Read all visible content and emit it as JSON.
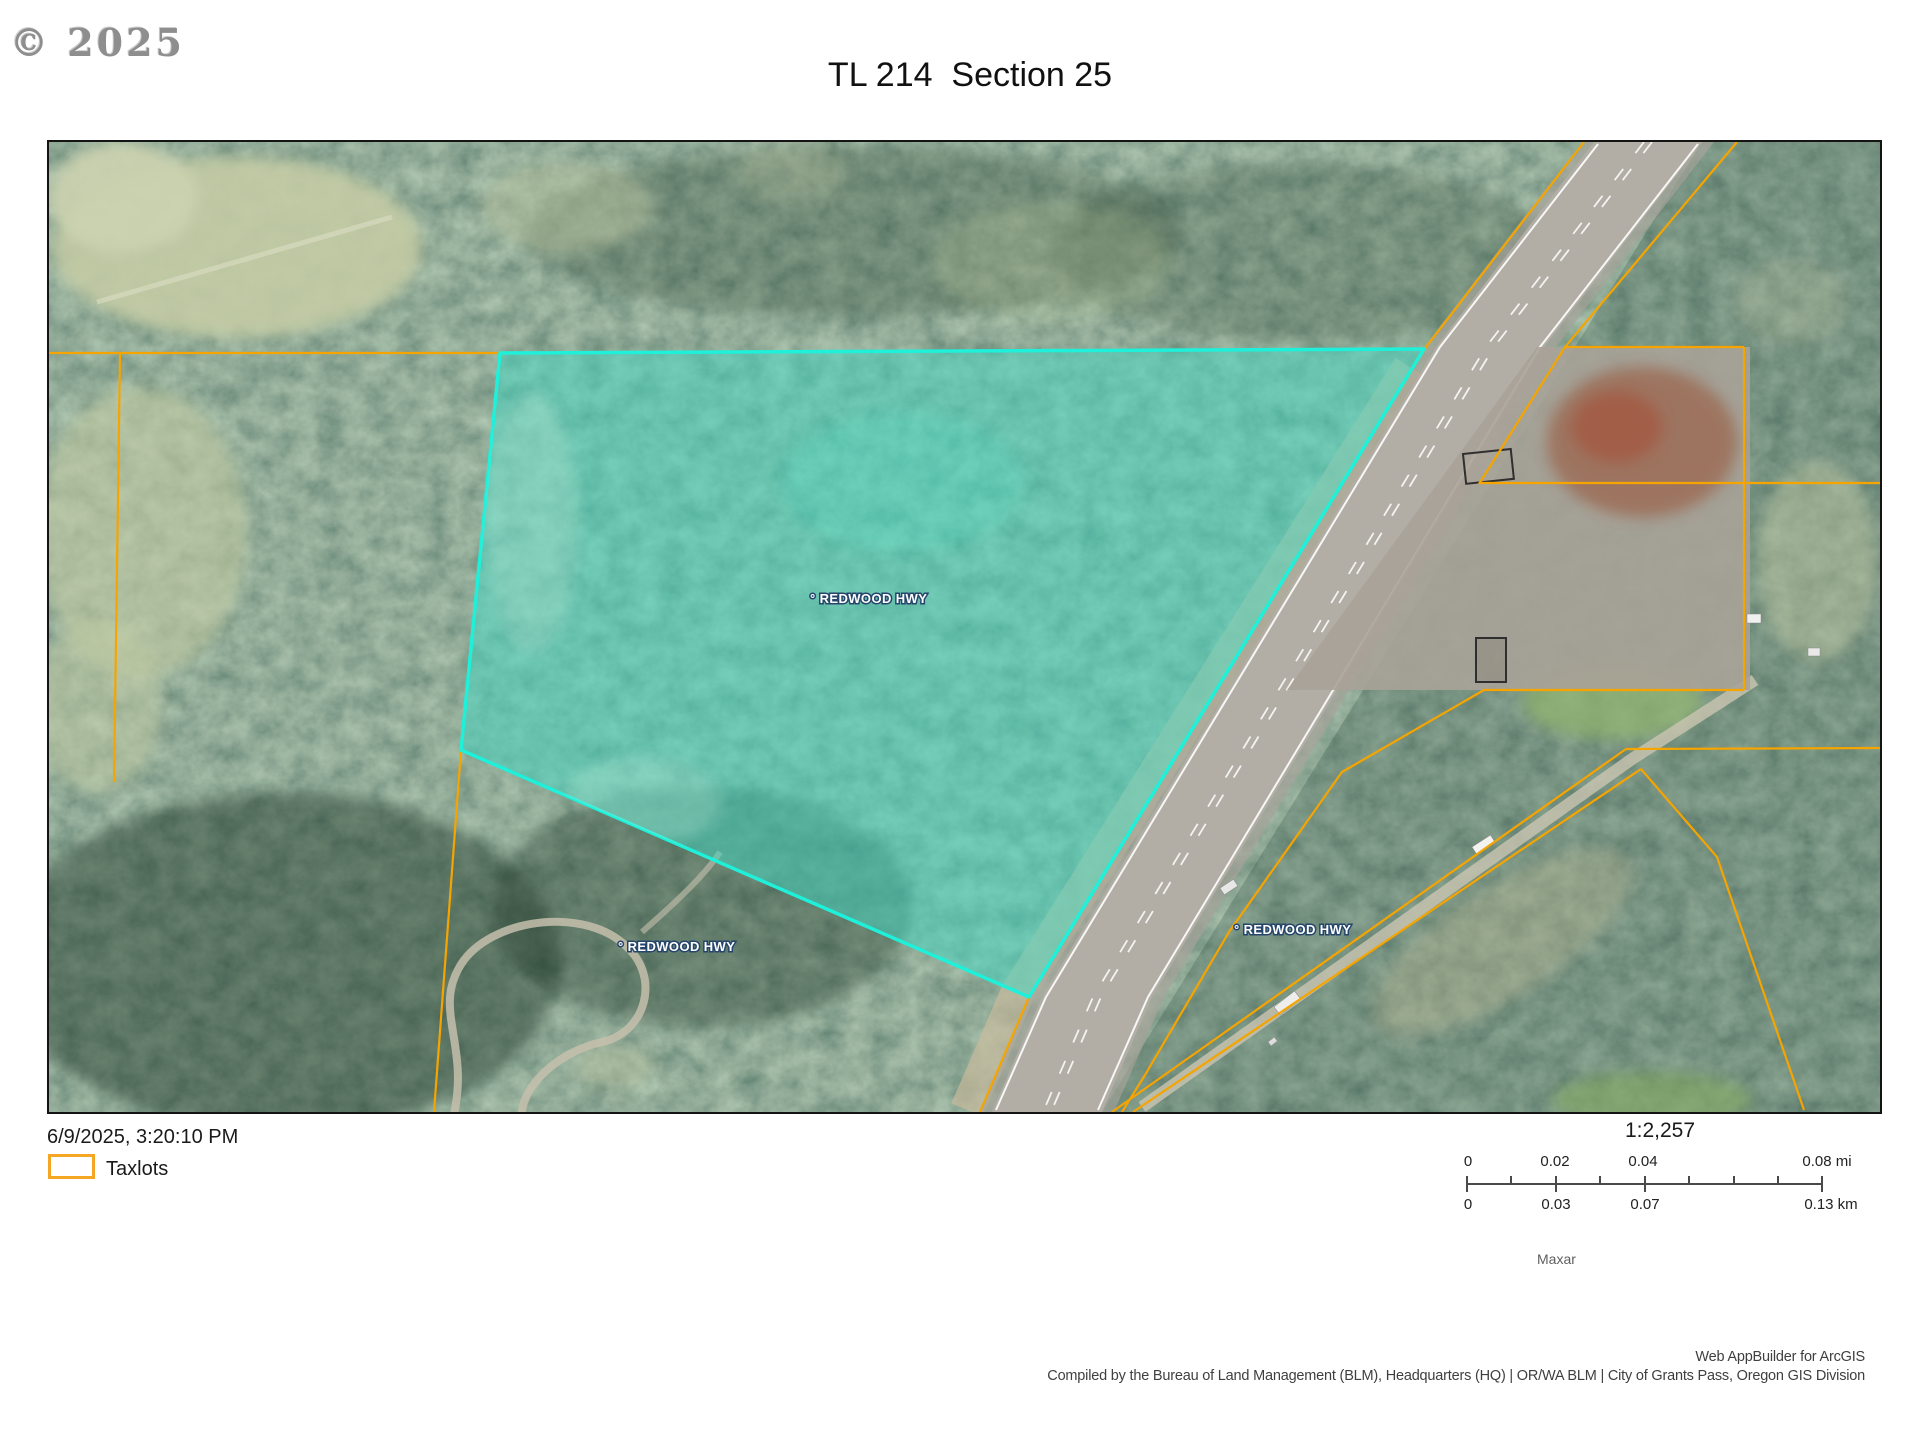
{
  "page": {
    "copyright": "© 2025",
    "title": "TL 214  Section 25"
  },
  "map": {
    "labels": {
      "hwy1": "° REDWOOD HWY",
      "hwy2": "° REDWOOD HWY",
      "hwy3": "° REDWOOD HWY"
    }
  },
  "footer": {
    "timestamp": "6/9/2025, 3:20:10 PM",
    "legend": {
      "taxlots": "Taxlots"
    },
    "scale": {
      "ratio": "1:2,257",
      "mi": [
        "0",
        "0.02",
        "0.04",
        "0.08 mi"
      ],
      "km": [
        "0",
        "0.03",
        "0.07",
        "0.13 km"
      ]
    },
    "attribution": {
      "imagery": "Maxar",
      "line1": "Web AppBuilder for ArcGIS",
      "line2": "Compiled by the Bureau of Land Management (BLM), Headquarters (HQ) | OR/WA BLM | City of Grants Pass, Oregon GIS Division"
    }
  },
  "colors": {
    "taxlot_orange": "#F5A400",
    "parcel_stroke": "#1FF0DA",
    "parcel_fill": "#3FD9C4"
  }
}
